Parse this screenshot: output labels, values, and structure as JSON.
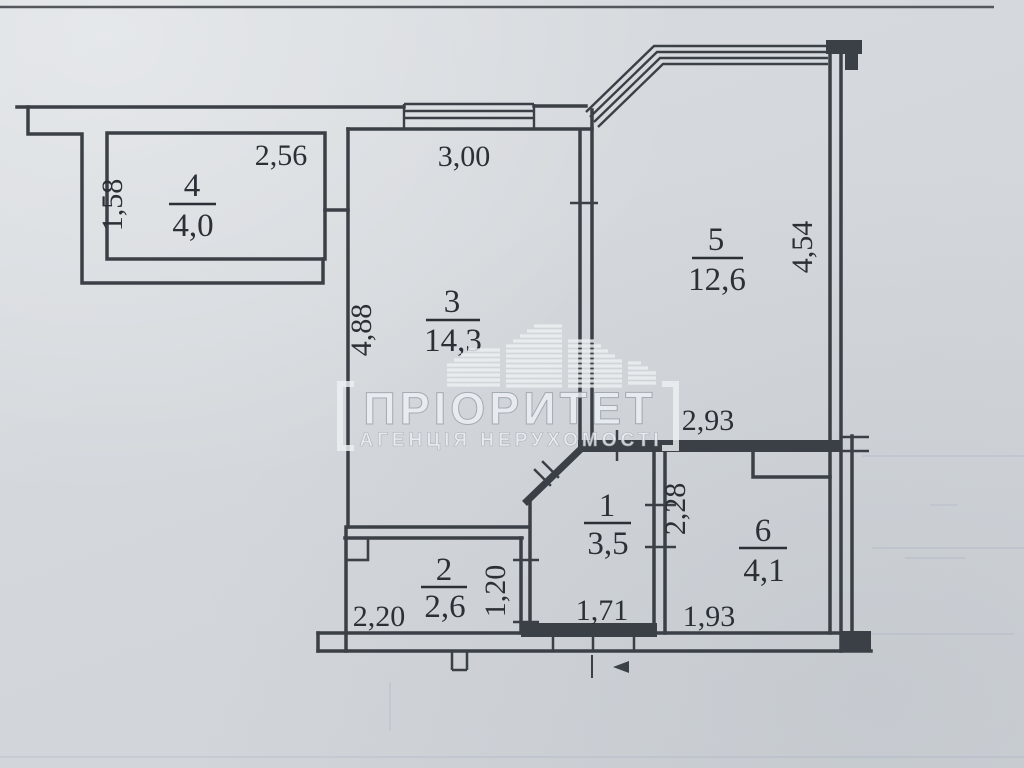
{
  "document": {
    "type": "apartment floor plan scan",
    "units_note": "dimensions in metres, areas in square metres"
  },
  "watermark": {
    "brand": "ПРІОРИТЕТ",
    "tagline": "АГЕНЦІЯ НЕРУХОМОСТІ"
  },
  "rooms": {
    "r1": {
      "number": "1",
      "area": "3,5",
      "dim_bottom": "1,71"
    },
    "r2": {
      "number": "2",
      "area": "2,6",
      "dim_bottom": "2,20",
      "dim_right": "1,20"
    },
    "r3": {
      "number": "3",
      "area": "14,3",
      "dim_top": "3,00",
      "dim_left": "4,88"
    },
    "r4": {
      "number": "4",
      "area": "4,0",
      "dim_top": "2,56",
      "dim_left": "1,58"
    },
    "r5": {
      "number": "5",
      "area": "12,6",
      "dim_right": "4,54",
      "dim_bottom": "2,93"
    },
    "r6": {
      "number": "6",
      "area": "4,1",
      "dim_bottom": "1,93",
      "dim_left": "2,28"
    }
  },
  "colors": {
    "paper": "#d5d9dd",
    "wall_ink": "#3b4046",
    "label_ink": "#2b3036",
    "scan_edge_line": "#54585d",
    "watermark": "#edf0f4"
  }
}
